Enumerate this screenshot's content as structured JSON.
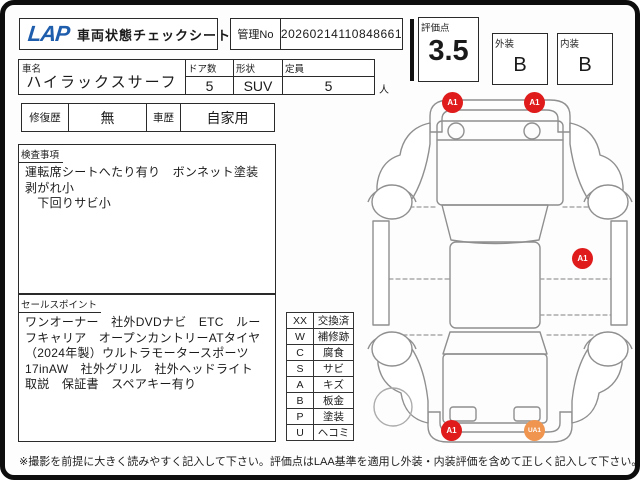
{
  "header": {
    "logo_text": "LAP",
    "sheet_title": "車両状態チェックシート",
    "manage_no_label": "管理No",
    "manage_no_value": "20260214110848661",
    "score_label": "評価点",
    "score_value": "3.5",
    "exterior_label": "外装",
    "exterior_grade": "B",
    "interior_label": "内装",
    "interior_grade": "B"
  },
  "vehicle": {
    "name_label": "車名",
    "name_value": "ハイラックスサーフ",
    "doors_label": "ドア数",
    "doors_value": "5",
    "body_label": "形状",
    "body_value": "SUV",
    "capacity_label": "定員",
    "capacity_value": "5",
    "capacity_unit": "人",
    "repair_label": "修復歴",
    "repair_value": "無",
    "history_label": "車歴",
    "history_value": "自家用"
  },
  "inspection": {
    "section_label": "検査事項",
    "notes": "運転席シートへたり有り　ボンネット塗装剥がれ小\n　下回りサビ小"
  },
  "sales": {
    "section_label": "セールスポイント",
    "notes": "ワンオーナー　社外DVDナビ　ETC　ルーフキャリア　オープンカントリーATタイヤ（2024年製）ウルトラモータースポーツ17inAW　社外グリル　社外ヘッドライト　取説　保証書　スペアキー有り"
  },
  "legend": {
    "rows": [
      {
        "code": "XX",
        "label": "交換済"
      },
      {
        "code": "W",
        "label": "補修跡"
      },
      {
        "code": "C",
        "label": "腐食"
      },
      {
        "code": "S",
        "label": "サビ"
      },
      {
        "code": "A",
        "label": "キズ"
      },
      {
        "code": "B",
        "label": "板金"
      },
      {
        "code": "P",
        "label": "塗装"
      },
      {
        "code": "U",
        "label": "ヘコミ"
      }
    ]
  },
  "diagram": {
    "markers": [
      {
        "label": "A1",
        "color": "#df1b1b",
        "location": "front-bumper-left"
      },
      {
        "label": "A1",
        "color": "#df1b1b",
        "location": "front-bumper-right"
      },
      {
        "label": "A1",
        "color": "#df1b1b",
        "location": "right-rear-door"
      },
      {
        "label": "A1",
        "color": "#df1b1b",
        "location": "rear-bumper-left"
      },
      {
        "label": "UA1",
        "color": "#ef9550",
        "location": "rear-bumper-right"
      }
    ]
  },
  "footer": {
    "note": "※撮影を前提に大きく読みやすく記入して下さい。評価点はLAA基準を適用し外装・内装評価を含めて正しく記入して下さい。"
  },
  "colors": {
    "logo_blue": "#1f5dad",
    "marker_red": "#df1b1b",
    "marker_orange": "#ef9550"
  }
}
